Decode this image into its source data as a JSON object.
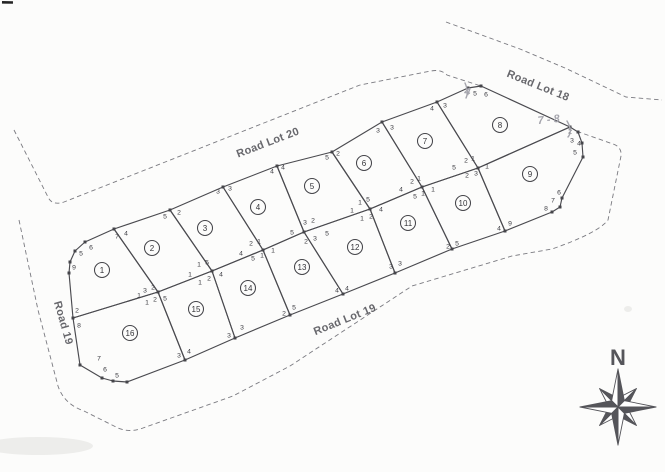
{
  "map": {
    "colors": {
      "ink": "#4a4a4f",
      "dashed_line": "#7a7a80",
      "pencil": "#a5a5ad",
      "road_text": "#5b5b60",
      "compass": "#55555a"
    },
    "roads": [
      {
        "id": "road-lot-20",
        "label": "Road Lot 20",
        "x": 268,
        "y": 143,
        "rot": -21
      },
      {
        "id": "road-lot-18",
        "label": "Road Lot 18",
        "x": 538,
        "y": 86,
        "rot": 22
      },
      {
        "id": "road-19",
        "label": "Road 19",
        "x": 63,
        "y": 323,
        "rot": 74
      },
      {
        "id": "road-lot-19",
        "label": "Road Lot 19",
        "x": 345,
        "y": 320,
        "rot": -22
      }
    ],
    "lots": [
      {
        "num": "1",
        "cx": 102,
        "cy": 270,
        "points": "114,229 158,292 73,318 69,273 70,262 75,251 85,242"
      },
      {
        "num": "2",
        "cx": 152,
        "cy": 248,
        "points": "114,229 170,210 212,271 158,292"
      },
      {
        "num": "3",
        "cx": 205,
        "cy": 228,
        "points": "170,210 223,187 263,250 212,271"
      },
      {
        "num": "4",
        "cx": 258,
        "cy": 207,
        "points": "223,187 277,166 304,232 263,250"
      },
      {
        "num": "5",
        "cx": 312,
        "cy": 186,
        "points": "277,166 332,152 370,209 304,232"
      },
      {
        "num": "6",
        "cx": 364,
        "cy": 163,
        "points": "332,152 382,122 422,187 370,209"
      },
      {
        "num": "7",
        "cx": 425,
        "cy": 141,
        "points": "382,122 437,102 478,168 422,187"
      },
      {
        "num": "8",
        "cx": 500,
        "cy": 125,
        "points": "437,102 468,88 481,86 570,127 478,168"
      },
      {
        "num": "9",
        "cx": 530,
        "cy": 174,
        "points": "478,168 570,127 578,132 582,143 583,157 562,198 560,207 552,212 505,231"
      },
      {
        "num": "10",
        "cx": 463,
        "cy": 203,
        "points": "422,187 478,168 505,231 452,249"
      },
      {
        "num": "11",
        "cx": 408,
        "cy": 223,
        "points": "370,209 422,187 452,249 395,273"
      },
      {
        "num": "12",
        "cx": 355,
        "cy": 247,
        "points": "304,232 370,209 395,273 343,294"
      },
      {
        "num": "13",
        "cx": 302,
        "cy": 267,
        "points": "263,250 304,232 343,294 290,315"
      },
      {
        "num": "14",
        "cx": 248,
        "cy": 288,
        "points": "212,271 263,250 290,315 235,338"
      },
      {
        "num": "15",
        "cx": 196,
        "cy": 309,
        "points": "158,292 212,271 235,338 185,360"
      },
      {
        "num": "16",
        "cx": 130,
        "cy": 333,
        "points": "73,318 158,292 185,360 127,382 113,381 102,378 80,365"
      }
    ],
    "corner_labels": [
      {
        "t": "6",
        "x": 91,
        "y": 247
      },
      {
        "t": "5",
        "x": 81,
        "y": 253
      },
      {
        "t": "9",
        "x": 74,
        "y": 267
      },
      {
        "t": "7",
        "x": 117,
        "y": 236
      },
      {
        "t": "4",
        "x": 126,
        "y": 233
      },
      {
        "t": "5",
        "x": 165,
        "y": 216
      },
      {
        "t": "2",
        "x": 179,
        "y": 212
      },
      {
        "t": "3",
        "x": 218,
        "y": 191
      },
      {
        "t": "3",
        "x": 230,
        "y": 188
      },
      {
        "t": "4",
        "x": 272,
        "y": 171
      },
      {
        "t": "4",
        "x": 283,
        "y": 167
      },
      {
        "t": "5",
        "x": 327,
        "y": 157
      },
      {
        "t": "2",
        "x": 338,
        "y": 153
      },
      {
        "t": "3",
        "x": 378,
        "y": 130
      },
      {
        "t": "3",
        "x": 392,
        "y": 127
      },
      {
        "t": "4",
        "x": 432,
        "y": 108
      },
      {
        "t": "3",
        "x": 445,
        "y": 105
      },
      {
        "t": "5",
        "x": 475,
        "y": 93
      },
      {
        "t": "6",
        "x": 486,
        "y": 94
      },
      {
        "t": "2",
        "x": 570,
        "y": 131
      },
      {
        "t": "3",
        "x": 572,
        "y": 140
      },
      {
        "t": "4",
        "x": 579,
        "y": 143
      },
      {
        "t": "5",
        "x": 575,
        "y": 152
      },
      {
        "t": "6",
        "x": 559,
        "y": 192
      },
      {
        "t": "7",
        "x": 553,
        "y": 200
      },
      {
        "t": "8",
        "x": 546,
        "y": 208
      },
      {
        "t": "4",
        "x": 499,
        "y": 228
      },
      {
        "t": "9",
        "x": 510,
        "y": 223
      },
      {
        "t": "2",
        "x": 448,
        "y": 246
      },
      {
        "t": "5",
        "x": 457,
        "y": 243
      },
      {
        "t": "3",
        "x": 391,
        "y": 266
      },
      {
        "t": "3",
        "x": 400,
        "y": 263
      },
      {
        "t": "4",
        "x": 337,
        "y": 290
      },
      {
        "t": "4",
        "x": 347,
        "y": 288
      },
      {
        "t": "2",
        "x": 284,
        "y": 313
      },
      {
        "t": "5",
        "x": 294,
        "y": 307
      },
      {
        "t": "3",
        "x": 229,
        "y": 335
      },
      {
        "t": "3",
        "x": 242,
        "y": 327
      },
      {
        "t": "3",
        "x": 179,
        "y": 355
      },
      {
        "t": "4",
        "x": 189,
        "y": 351
      },
      {
        "t": "2",
        "x": 77,
        "y": 310
      },
      {
        "t": "8",
        "x": 79,
        "y": 325
      },
      {
        "t": "7",
        "x": 99,
        "y": 358
      },
      {
        "t": "6",
        "x": 105,
        "y": 369
      },
      {
        "t": "5",
        "x": 117,
        "y": 375
      },
      {
        "t": "3",
        "x": 145,
        "y": 290
      },
      {
        "t": "2",
        "x": 153,
        "y": 287
      },
      {
        "t": "1",
        "x": 139,
        "y": 295
      },
      {
        "t": "1",
        "x": 147,
        "y": 302
      },
      {
        "t": "2",
        "x": 155,
        "y": 299
      },
      {
        "t": "5",
        "x": 165,
        "y": 298
      },
      {
        "t": "1",
        "x": 190,
        "y": 274
      },
      {
        "t": "1",
        "x": 199,
        "y": 264
      },
      {
        "t": "5",
        "x": 207,
        "y": 262
      },
      {
        "t": "1",
        "x": 200,
        "y": 282
      },
      {
        "t": "2",
        "x": 209,
        "y": 278
      },
      {
        "t": "4",
        "x": 221,
        "y": 274
      },
      {
        "t": "2",
        "x": 251,
        "y": 243
      },
      {
        "t": "1",
        "x": 259,
        "y": 241
      },
      {
        "t": "4",
        "x": 241,
        "y": 253
      },
      {
        "t": "5",
        "x": 253,
        "y": 258
      },
      {
        "t": "1",
        "x": 262,
        "y": 255
      },
      {
        "t": "1",
        "x": 273,
        "y": 250
      },
      {
        "t": "3",
        "x": 305,
        "y": 222
      },
      {
        "t": "2",
        "x": 313,
        "y": 220
      },
      {
        "t": "5",
        "x": 292,
        "y": 232
      },
      {
        "t": "2",
        "x": 306,
        "y": 241
      },
      {
        "t": "3",
        "x": 315,
        "y": 238
      },
      {
        "t": "5",
        "x": 327,
        "y": 233
      },
      {
        "t": "1",
        "x": 352,
        "y": 210
      },
      {
        "t": "1",
        "x": 360,
        "y": 202
      },
      {
        "t": "5",
        "x": 368,
        "y": 199
      },
      {
        "t": "1",
        "x": 362,
        "y": 218
      },
      {
        "t": "2",
        "x": 371,
        "y": 216
      },
      {
        "t": "4",
        "x": 381,
        "y": 209
      },
      {
        "t": "4",
        "x": 401,
        "y": 189
      },
      {
        "t": "2",
        "x": 412,
        "y": 181
      },
      {
        "t": "1",
        "x": 419,
        "y": 178
      },
      {
        "t": "5",
        "x": 415,
        "y": 196
      },
      {
        "t": "1",
        "x": 423,
        "y": 193
      },
      {
        "t": "1",
        "x": 433,
        "y": 189
      },
      {
        "t": "2",
        "x": 466,
        "y": 160
      },
      {
        "t": "1",
        "x": 473,
        "y": 158
      },
      {
        "t": "5",
        "x": 454,
        "y": 167
      },
      {
        "t": "2",
        "x": 467,
        "y": 175
      },
      {
        "t": "3",
        "x": 476,
        "y": 173
      },
      {
        "t": "1",
        "x": 487,
        "y": 166
      }
    ],
    "dots": [
      [
        114,
        229
      ],
      [
        170,
        210
      ],
      [
        223,
        187
      ],
      [
        277,
        166
      ],
      [
        332,
        152
      ],
      [
        382,
        122
      ],
      [
        437,
        102
      ],
      [
        468,
        88
      ],
      [
        481,
        86
      ],
      [
        570,
        127
      ],
      [
        478,
        168
      ],
      [
        422,
        187
      ],
      [
        370,
        209
      ],
      [
        304,
        232
      ],
      [
        263,
        250
      ],
      [
        212,
        271
      ],
      [
        158,
        292
      ],
      [
        73,
        318
      ],
      [
        185,
        360
      ],
      [
        235,
        338
      ],
      [
        290,
        315
      ],
      [
        343,
        294
      ],
      [
        395,
        273
      ],
      [
        452,
        249
      ],
      [
        505,
        231
      ],
      [
        85,
        242
      ],
      [
        75,
        251
      ],
      [
        70,
        262
      ],
      [
        69,
        273
      ],
      [
        80,
        365
      ],
      [
        102,
        378
      ],
      [
        113,
        381
      ],
      [
        127,
        382
      ],
      [
        578,
        132
      ],
      [
        582,
        143
      ],
      [
        583,
        157
      ],
      [
        562,
        198
      ],
      [
        560,
        207
      ],
      [
        552,
        212
      ]
    ],
    "dashed_paths": [
      "M 14 130 L 48 197 Q 52 206 64 202 L 360 85 L 431 71 Q 441 69 447 75 L 481 86",
      "M 19 220 L 38 310 L 58 386 Q 64 404 84 411 L 118 428 Q 130 433 143 428 L 233 396 L 290 366 L 412 286 L 512 256 L 552 249 Q 598 233 608 220 L 621 156 Q 622 147 613 144 L 576 131",
      "M 446 22 L 520 49 L 565 68 L 626 97 L 662 100"
    ],
    "pencil": {
      "texts": [
        {
          "t": "7 - 8",
          "x": 549,
          "y": 123,
          "rot": -6
        },
        {
          "t": "4",
          "x": 467,
          "y": 95,
          "rot": 8
        }
      ],
      "strokes": [
        "M 465 83 q 4 9 1 15",
        "M 567 121 q 6 10 1 16"
      ]
    },
    "compass": {
      "label": "N",
      "cx": 618,
      "cy": 407
    }
  }
}
